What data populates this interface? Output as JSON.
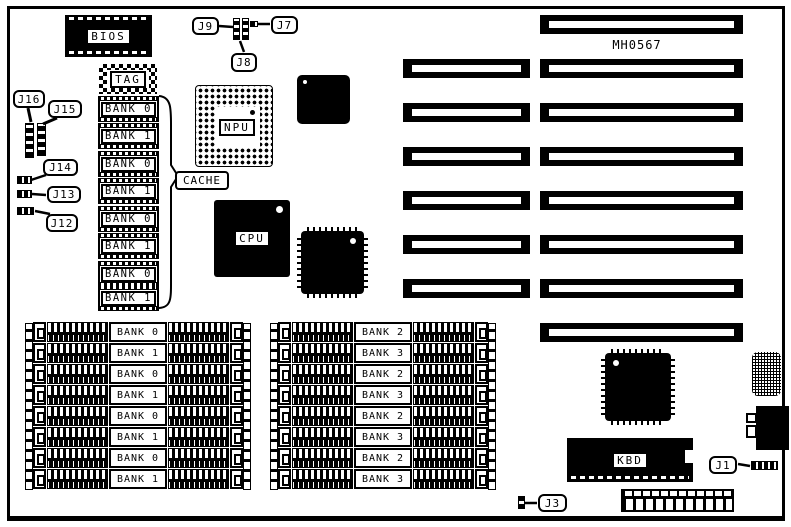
{
  "board": {
    "part_number": "MH0567"
  },
  "labels": {
    "bios": "BIOS",
    "tag": "TAG",
    "npu": "NPU",
    "cache": "CACHE",
    "cpu": "CPU",
    "kbd": "KBD"
  },
  "callouts": {
    "j1": "J1",
    "j3": "J3",
    "j7": "J7",
    "j8": "J8",
    "j9": "J9",
    "j12": "J12",
    "j13": "J13",
    "j14": "J14",
    "j15": "J15",
    "j16": "J16"
  },
  "cache_column": {
    "chips": [
      "BANK 0",
      "BANK 1",
      "BANK 0",
      "BANK 1",
      "BANK 0",
      "BANK 1",
      "BANK 0",
      "BANK 1"
    ]
  },
  "memory": {
    "left_group": [
      "BANK 0",
      "BANK 1",
      "BANK 0",
      "BANK 1",
      "BANK 0",
      "BANK 1",
      "BANK 0",
      "BANK 1"
    ],
    "right_group": [
      "BANK 2",
      "BANK 3",
      "BANK 2",
      "BANK 3",
      "BANK 2",
      "BANK 3",
      "BANK 2",
      "BANK 3"
    ]
  },
  "colors": {
    "ink": "#000000",
    "paper": "#ffffff"
  }
}
